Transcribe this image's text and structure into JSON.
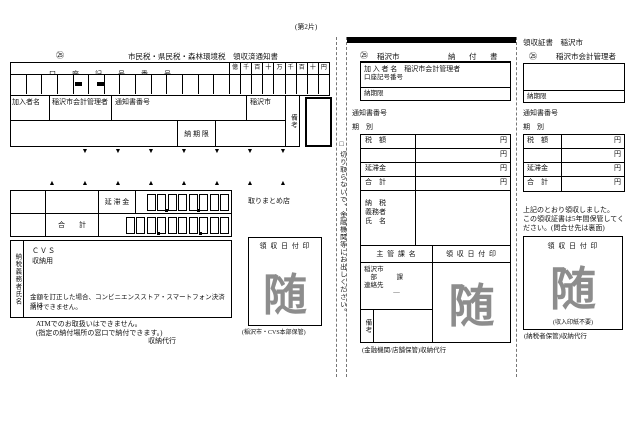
{
  "page": {
    "sheet_label": "(第2片)"
  },
  "left": {
    "mark": "㉕",
    "title": "市民税・県民税・森林環境税　領収済通知書",
    "account_label": "口座記号番号",
    "digits": [
      "億",
      "千",
      "百",
      "十",
      "万",
      "千",
      "百",
      "十",
      "円"
    ],
    "payer_label": "加入者名",
    "payer_value": "稲沢市会計管理者",
    "notice_label": "通知書番号",
    "city": "稲沢市",
    "remarks": "備考",
    "due": "納 期 限",
    "delay": "延 滞 金",
    "total": "合　　計",
    "store": "取りまとめ店",
    "taxpayer_vertical": "納税義務者氏名",
    "cvs1": "ＣＶＳ",
    "cvs2": "収納用",
    "warn1": "金額を訂正した場合、コンビニエンスストア・スマートフォン決済では",
    "warn2": "納付できません。",
    "atm1": "ATMでのお取扱いはできません。",
    "atm2": "(指定の納付場所の窓口で納付できます。)",
    "agency": "収納代行",
    "stamp_header": "領 収 日 付 印",
    "stamp": "随",
    "keep": "(稲沢市・CVS本部保管)"
  },
  "strip": {
    "checkbox": "□",
    "text": "切り取らないで、金融機関等にお出しください。"
  },
  "middle": {
    "mark": "㉕",
    "city": "稲沢市",
    "title": "納　付　書",
    "payer_line": "加 入 者 名　稲沢市会計管理者",
    "account_line": "口座記号番号",
    "due": "納期限",
    "notice": "通知書番号",
    "period": "期　別",
    "rows": [
      {
        "label": "税　額",
        "unit": "円"
      },
      {
        "label": "",
        "unit": "円"
      },
      {
        "label": "延滞金",
        "unit": "円"
      },
      {
        "label": "合　計",
        "unit": "円"
      }
    ],
    "taxpayer_l1": "納　税",
    "taxpayer_l2": "義務者",
    "taxpayer_l3": "氏　名",
    "dept_header": "主 管 課 名",
    "stamp_header": "領 収 日 付 印",
    "dept1": "稲沢市",
    "dept2": "　部　　　課",
    "dept3": "連絡先",
    "dept4": "―",
    "remarks": "備考",
    "stamp": "随",
    "keep": "(金融機関/店舗保管)収納代行"
  },
  "right": {
    "title": "領収証書　稲沢市",
    "mark": "㉕",
    "payer": "稲沢市会計管理者",
    "due": "納期限",
    "notice": "通知書番号",
    "period": "期　別",
    "rows": [
      {
        "label": "税　額",
        "unit": "円"
      },
      {
        "label": "",
        "unit": "円"
      },
      {
        "label": "延滞金",
        "unit": "円"
      },
      {
        "label": "合　計",
        "unit": "円"
      }
    ],
    "note1": "上記のとおり領収しました。",
    "note2": "この領収証書は5年間保管してく",
    "note3": "ださい。(問合せ先は裏面)",
    "stamp_header": "領 収 日 付 印",
    "stamp": "随",
    "no_revenue_stamp": "(収入印紙不要)",
    "keep": "(納税者保管)収納代行"
  }
}
